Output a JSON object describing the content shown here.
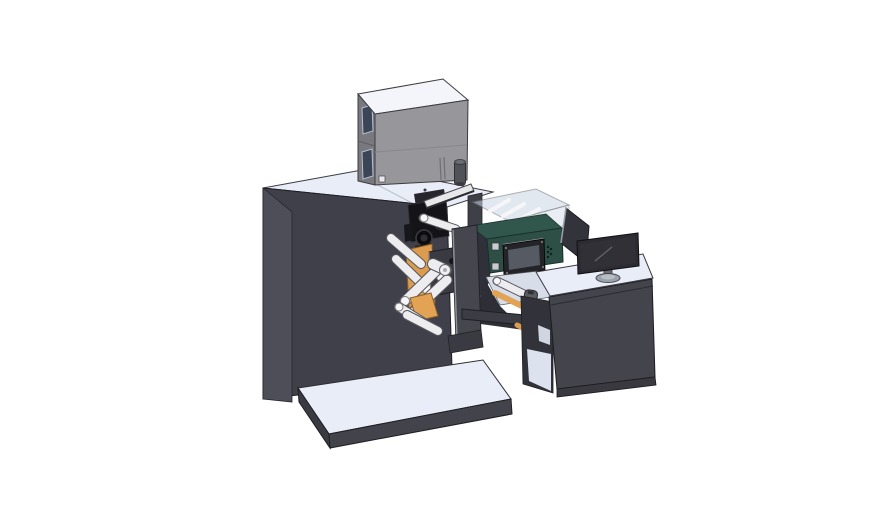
{
  "scene": {
    "background": "#ffffff",
    "parts": [
      "main-cabinet",
      "base-platform",
      "electrical-box",
      "print-head-assembly",
      "guide-rail",
      "web-rollers",
      "unwind-orange-plates",
      "frame-plate",
      "hmi-control-box",
      "transparent-guard",
      "side-panel",
      "connecting-beam",
      "sensor-bracket",
      "operator-desk",
      "desk-monitor"
    ]
  },
  "colors": {
    "background": "#ffffff",
    "surface_light": "#e9edf7",
    "surface_bright": "#f3f5fa",
    "deck_light": "#d7dde9",
    "cabinet_front": "#40404a",
    "cabinet_left": "#4e4e58",
    "platform_front": "#43434c",
    "platform_left": "#3a3a42",
    "desk_front": "#44444d",
    "desk_kick": "#39393f",
    "desk_leg": "#32323a",
    "desk_interior": "#dde3ee",
    "desk_interior_upper": "#cfd6e2",
    "graybox_front": "#97979b",
    "graybox_left": "#78787e",
    "graybox_top": "#f3f5fa",
    "graybox_window": "#3a4656",
    "graybox_cylinder": "#515158",
    "teal_front": "#2d4f45",
    "teal_top": "#31564c",
    "hmi_bezel": "#232328",
    "hmi_screen": "#565b63",
    "panel_dark": "#33333b",
    "panel_edge": "#9aa0a8",
    "plate_dark": "#3a3a42",
    "tall_plate": "#46464f",
    "frame_filler": "#30303a",
    "mech_black": "#141418",
    "mech_dark2": "#26262c",
    "rail_white": "#e8e8ea",
    "roller_light": "#ededf0",
    "roller_outline": "#55555c",
    "orange": "#dc9c50",
    "orange_bright": "#e2a355",
    "magenta": "#b55bb0",
    "enclosure_glass": "#ccd6e4",
    "monitor_bezel": "#2b2b31",
    "monitor_screen": "#303036",
    "monitor_base": "#9ba1ab",
    "monitor_neck": "#6b6b72",
    "beam": "#3c3c44",
    "bracket": "#5a5a62"
  }
}
